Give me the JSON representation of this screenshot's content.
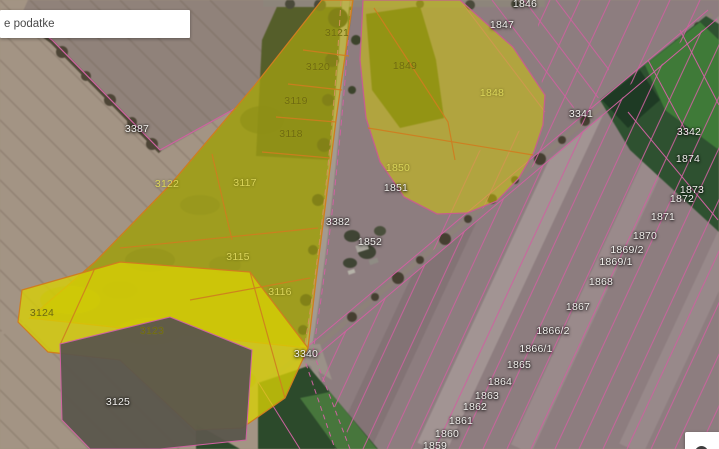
{
  "search": {
    "value": "e podatke"
  },
  "map": {
    "highlight_color": "#d8ce00",
    "boundary_color": "#ce62a0",
    "selected_boundary_color": "#cf7d1f",
    "controls": {
      "panorama_button": {
        "icon": "panorama-icon"
      }
    },
    "parcel_labels": [
      {
        "label": "3387",
        "x": 137,
        "y": 129,
        "color": "white"
      },
      {
        "label": "3121",
        "x": 337,
        "y": 33,
        "color": "dark"
      },
      {
        "label": "3120",
        "x": 318,
        "y": 67,
        "color": "dark"
      },
      {
        "label": "3119",
        "x": 296,
        "y": 101,
        "color": "dark"
      },
      {
        "label": "3118",
        "x": 291,
        "y": 134,
        "color": "dark"
      },
      {
        "label": "3122",
        "x": 167,
        "y": 184,
        "color": "bright"
      },
      {
        "label": "3117",
        "x": 245,
        "y": 183,
        "color": "bright"
      },
      {
        "label": "3115",
        "x": 238,
        "y": 257,
        "color": "bright"
      },
      {
        "label": "3116",
        "x": 280,
        "y": 292,
        "color": "bright"
      },
      {
        "label": "3124",
        "x": 42,
        "y": 313,
        "color": "dark"
      },
      {
        "label": "3123",
        "x": 152,
        "y": 331,
        "color": "dark"
      },
      {
        "label": "3125",
        "x": 118,
        "y": 402,
        "color": "white"
      },
      {
        "label": "3340",
        "x": 306,
        "y": 354,
        "color": "white"
      },
      {
        "label": "3382",
        "x": 338,
        "y": 222,
        "color": "white"
      },
      {
        "label": "1852",
        "x": 370,
        "y": 242,
        "color": "white"
      },
      {
        "label": "1851",
        "x": 396,
        "y": 188,
        "color": "white"
      },
      {
        "label": "1850",
        "x": 398,
        "y": 168,
        "color": "bright"
      },
      {
        "label": "1849",
        "x": 405,
        "y": 66,
        "color": "dark"
      },
      {
        "label": "1848",
        "x": 492,
        "y": 93,
        "color": "bright"
      },
      {
        "label": "1846",
        "x": 525,
        "y": 4,
        "color": "white"
      },
      {
        "label": "1847",
        "x": 502,
        "y": 25,
        "color": "white"
      },
      {
        "label": "3341",
        "x": 581,
        "y": 114,
        "color": "white"
      },
      {
        "label": "3342",
        "x": 689,
        "y": 132,
        "color": "white"
      },
      {
        "label": "1874",
        "x": 688,
        "y": 159,
        "color": "white"
      },
      {
        "label": "1873",
        "x": 692,
        "y": 190,
        "color": "white"
      },
      {
        "label": "1872",
        "x": 682,
        "y": 199,
        "color": "white"
      },
      {
        "label": "1871",
        "x": 663,
        "y": 217,
        "color": "white"
      },
      {
        "label": "1870",
        "x": 645,
        "y": 236,
        "color": "white"
      },
      {
        "label": "1869/2",
        "x": 627,
        "y": 250,
        "color": "white"
      },
      {
        "label": "1869/1",
        "x": 616,
        "y": 262,
        "color": "white"
      },
      {
        "label": "1868",
        "x": 601,
        "y": 282,
        "color": "white"
      },
      {
        "label": "1867",
        "x": 578,
        "y": 307,
        "color": "white"
      },
      {
        "label": "1866/2",
        "x": 553,
        "y": 331,
        "color": "white"
      },
      {
        "label": "1866/1",
        "x": 536,
        "y": 349,
        "color": "white"
      },
      {
        "label": "1865",
        "x": 519,
        "y": 365,
        "color": "white"
      },
      {
        "label": "1864",
        "x": 500,
        "y": 382,
        "color": "white"
      },
      {
        "label": "1863",
        "x": 487,
        "y": 396,
        "color": "white"
      },
      {
        "label": "1862",
        "x": 475,
        "y": 407,
        "color": "white"
      },
      {
        "label": "1861",
        "x": 461,
        "y": 421,
        "color": "white"
      },
      {
        "label": "1860",
        "x": 447,
        "y": 434,
        "color": "white"
      },
      {
        "label": "1859",
        "x": 435,
        "y": 446,
        "color": "white"
      }
    ]
  }
}
